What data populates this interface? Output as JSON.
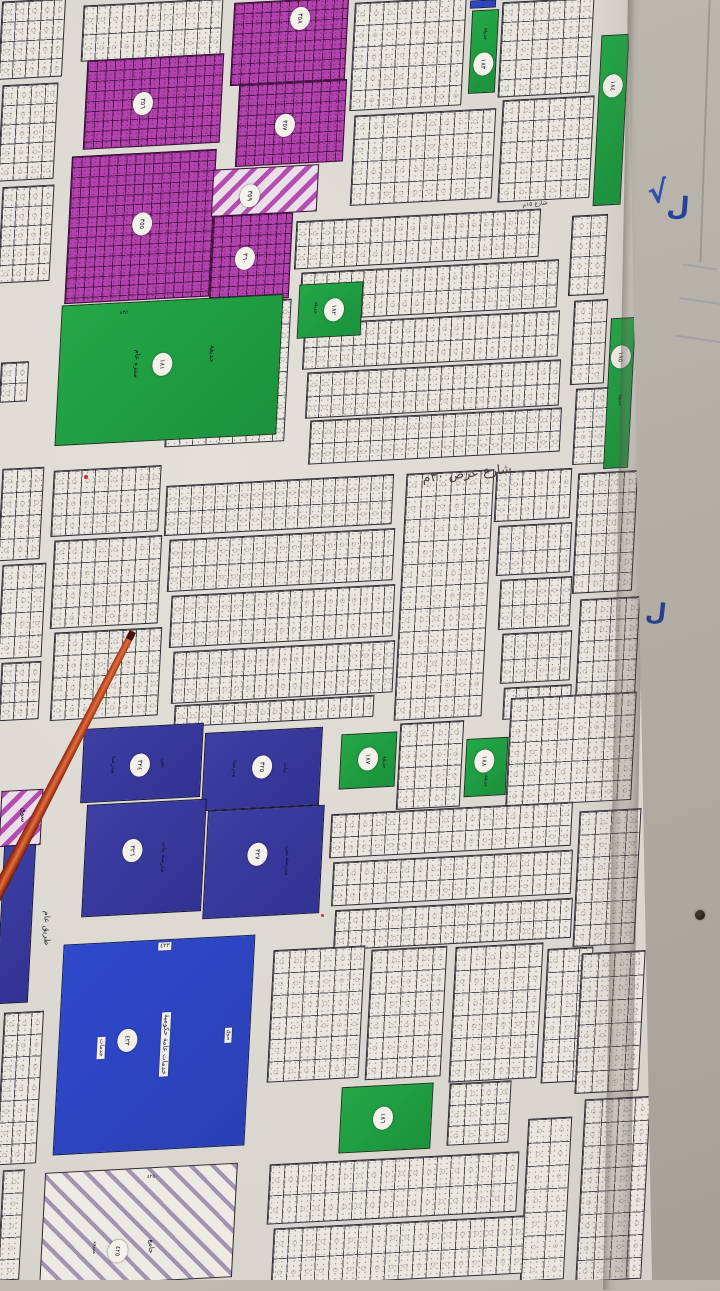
{
  "map": {
    "blocks": [
      {
        "x": 0,
        "y": 0,
        "w": 64,
        "h": 78,
        "t": "g",
        "c": 5,
        "r": 4
      },
      {
        "x": 0,
        "y": 84,
        "w": 56,
        "h": 96,
        "t": "g",
        "c": 4,
        "r": 5
      },
      {
        "x": 0,
        "y": 186,
        "w": 52,
        "h": 96,
        "t": "g",
        "c": 4,
        "r": 5
      },
      {
        "x": 82,
        "y": 2,
        "w": 140,
        "h": 56,
        "t": "g",
        "c": 11,
        "r": 2
      },
      {
        "x": 0,
        "y": 362,
        "w": 28,
        "h": 40,
        "t": "g",
        "c": 2,
        "r": 2
      },
      {
        "x": 352,
        "y": 0,
        "w": 112,
        "h": 108,
        "t": "g",
        "c": 8,
        "r": 5
      },
      {
        "x": 500,
        "y": 0,
        "w": 92,
        "h": 95,
        "t": "g",
        "c": 6,
        "r": 5
      },
      {
        "x": 500,
        "y": 98,
        "w": 92,
        "h": 102,
        "t": "g",
        "c": 6,
        "r": 5
      },
      {
        "x": 352,
        "y": 112,
        "w": 142,
        "h": 90,
        "t": "g",
        "c": 10,
        "r": 4
      },
      {
        "x": 235,
        "y": 218,
        "w": 52,
        "h": 80,
        "t": "g",
        "c": 4,
        "r": 4
      },
      {
        "x": 168,
        "y": 302,
        "w": 120,
        "h": 142,
        "t": "g",
        "c": 9,
        "r": 6
      },
      {
        "x": 295,
        "y": 215,
        "w": 245,
        "h": 48,
        "t": "g",
        "c": 20,
        "r": 2
      },
      {
        "x": 300,
        "y": 266,
        "w": 258,
        "h": 48,
        "t": "g",
        "c": 21,
        "r": 2
      },
      {
        "x": 303,
        "y": 317,
        "w": 256,
        "h": 46,
        "t": "g",
        "c": 21,
        "r": 2
      },
      {
        "x": 306,
        "y": 366,
        "w": 254,
        "h": 46,
        "t": "g",
        "c": 21,
        "r": 2
      },
      {
        "x": 309,
        "y": 414,
        "w": 252,
        "h": 44,
        "t": "g",
        "c": 21,
        "r": 2
      },
      {
        "x": 570,
        "y": 215,
        "w": 36,
        "h": 80,
        "t": "g",
        "c": 2,
        "r": 4
      },
      {
        "x": 572,
        "y": 300,
        "w": 34,
        "h": 84,
        "t": "g",
        "c": 2,
        "r": 4
      },
      {
        "x": 574,
        "y": 388,
        "w": 34,
        "h": 76,
        "t": "g",
        "c": 2,
        "r": 4
      },
      {
        "x": 0,
        "y": 468,
        "w": 42,
        "h": 92,
        "t": "g",
        "c": 3,
        "r": 4
      },
      {
        "x": 0,
        "y": 564,
        "w": 44,
        "h": 94,
        "t": "g",
        "c": 3,
        "r": 4
      },
      {
        "x": 0,
        "y": 662,
        "w": 40,
        "h": 58,
        "t": "g",
        "c": 3,
        "r": 3
      },
      {
        "x": 52,
        "y": 468,
        "w": 108,
        "h": 66,
        "t": "g",
        "c": 8,
        "r": 3
      },
      {
        "x": 52,
        "y": 538,
        "w": 108,
        "h": 88,
        "t": "g",
        "c": 8,
        "r": 4
      },
      {
        "x": 52,
        "y": 630,
        "w": 108,
        "h": 88,
        "t": "g",
        "c": 8,
        "r": 4
      },
      {
        "x": 165,
        "y": 480,
        "w": 228,
        "h": 50,
        "t": "g",
        "c": 19,
        "r": 2
      },
      {
        "x": 168,
        "y": 534,
        "w": 226,
        "h": 52,
        "t": "g",
        "c": 19,
        "r": 2
      },
      {
        "x": 170,
        "y": 590,
        "w": 224,
        "h": 52,
        "t": "g",
        "c": 19,
        "r": 2
      },
      {
        "x": 172,
        "y": 646,
        "w": 222,
        "h": 52,
        "t": "g",
        "c": 19,
        "r": 2
      },
      {
        "x": 174,
        "y": 700,
        "w": 200,
        "h": 22,
        "t": "g",
        "c": 17,
        "r": 1
      },
      {
        "x": 400,
        "y": 472,
        "w": 88,
        "h": 246,
        "t": "g",
        "c": 6,
        "r": 11
      },
      {
        "x": 495,
        "y": 470,
        "w": 76,
        "h": 50,
        "t": "g",
        "c": 6,
        "r": 2
      },
      {
        "x": 497,
        "y": 524,
        "w": 74,
        "h": 50,
        "t": "g",
        "c": 6,
        "r": 2
      },
      {
        "x": 499,
        "y": 578,
        "w": 72,
        "h": 50,
        "t": "g",
        "c": 6,
        "r": 2
      },
      {
        "x": 501,
        "y": 632,
        "w": 70,
        "h": 50,
        "t": "g",
        "c": 6,
        "r": 2
      },
      {
        "x": 503,
        "y": 686,
        "w": 68,
        "h": 32,
        "t": "g",
        "c": 6,
        "r": 1
      },
      {
        "x": 575,
        "y": 472,
        "w": 60,
        "h": 120,
        "t": "g",
        "c": 4,
        "r": 6
      },
      {
        "x": 577,
        "y": 598,
        "w": 60,
        "h": 122,
        "t": "g",
        "c": 4,
        "r": 6
      },
      {
        "x": 398,
        "y": 722,
        "w": 64,
        "h": 86,
        "t": "g",
        "c": 4,
        "r": 4
      },
      {
        "x": 508,
        "y": 695,
        "w": 126,
        "h": 108,
        "t": "g",
        "c": 8,
        "r": 5
      },
      {
        "x": 330,
        "y": 808,
        "w": 242,
        "h": 44,
        "t": "g",
        "c": 18,
        "r": 2
      },
      {
        "x": 332,
        "y": 856,
        "w": 240,
        "h": 44,
        "t": "g",
        "c": 18,
        "r": 2
      },
      {
        "x": 334,
        "y": 904,
        "w": 238,
        "h": 40,
        "t": "g",
        "c": 18,
        "r": 2
      },
      {
        "x": 576,
        "y": 810,
        "w": 62,
        "h": 135,
        "t": "g",
        "c": 4,
        "r": 6
      },
      {
        "x": 0,
        "y": 1012,
        "w": 40,
        "h": 152,
        "t": "g",
        "c": 3,
        "r": 7
      },
      {
        "x": 0,
        "y": 1170,
        "w": 22,
        "h": 110,
        "t": "g",
        "c": 1,
        "r": 5
      },
      {
        "x": 270,
        "y": 948,
        "w": 92,
        "h": 132,
        "t": "g",
        "c": 6,
        "r": 6
      },
      {
        "x": 368,
        "y": 948,
        "w": 76,
        "h": 130,
        "t": "g",
        "c": 5,
        "r": 6
      },
      {
        "x": 452,
        "y": 945,
        "w": 88,
        "h": 135,
        "t": "g",
        "c": 6,
        "r": 6
      },
      {
        "x": 544,
        "y": 948,
        "w": 46,
        "h": 134,
        "t": "g",
        "c": 3,
        "r": 6
      },
      {
        "x": 578,
        "y": 952,
        "w": 64,
        "h": 140,
        "t": "g",
        "c": 4,
        "r": 6
      },
      {
        "x": 524,
        "y": 1118,
        "w": 44,
        "h": 162,
        "t": "g",
        "c": 2,
        "r": 7
      },
      {
        "x": 580,
        "y": 1098,
        "w": 66,
        "h": 182,
        "t": "g",
        "c": 4,
        "r": 8
      },
      {
        "x": 448,
        "y": 1082,
        "w": 62,
        "h": 62,
        "t": "g",
        "c": 4,
        "r": 3
      },
      {
        "x": 268,
        "y": 1158,
        "w": 250,
        "h": 60,
        "t": "g",
        "c": 18,
        "r": 2
      },
      {
        "x": 272,
        "y": 1222,
        "w": 252,
        "h": 58,
        "t": "g",
        "c": 18,
        "r": 2
      },
      {
        "x": 232,
        "y": 0,
        "w": 115,
        "h": 83,
        "t": "p",
        "circ": {
          "cx": 58,
          "cy": 22,
          "n": "٣٥٨"
        }
      },
      {
        "x": 85,
        "y": 57,
        "w": 137,
        "h": 89,
        "t": "p",
        "circ": {
          "cx": 42,
          "cy": 52,
          "n": "٣٥٦"
        }
      },
      {
        "x": 237,
        "y": 82,
        "w": 108,
        "h": 82,
        "t": "p",
        "circ": {
          "cx": 44,
          "cy": 52,
          "n": "٣٥٧"
        }
      },
      {
        "x": 68,
        "y": 153,
        "w": 145,
        "h": 147,
        "t": "p",
        "circ": {
          "cx": 51,
          "cy": 48,
          "n": "٣٥٥"
        }
      },
      {
        "x": 212,
        "y": 167,
        "w": 106,
        "h": 47,
        "t": "hp",
        "circ": {
          "cx": 36,
          "cy": 60,
          "n": "٣٥٩"
        }
      },
      {
        "x": 211,
        "y": 214,
        "w": 80,
        "h": 86,
        "t": "p",
        "circ": {
          "cx": 42,
          "cy": 51,
          "n": "٣٦٠"
        }
      },
      {
        "x": 58,
        "y": 300,
        "w": 222,
        "h": 140,
        "t": "gr",
        "circ": {
          "cx": 47,
          "cy": 46,
          "n": "١٨١"
        },
        "labels": [
          {
            "t": "منتزه عام",
            "dx": 35,
            "dy": 44,
            "rot": 90,
            "s": 7
          },
          {
            "t": "حديقة",
            "dx": 69,
            "dy": 40,
            "rot": 90,
            "s": 7
          },
          {
            "t": "٤٣٥",
            "dx": 28,
            "dy": 7,
            "s": 5
          }
        ]
      },
      {
        "x": 298,
        "y": 283,
        "w": 64,
        "h": 54,
        "t": "gr",
        "circ": {
          "cx": 56,
          "cy": 50,
          "n": "١٨٢"
        },
        "labels": [
          {
            "t": "حديقة",
            "dx": 26,
            "dy": 45,
            "rot": 90,
            "s": 5
          }
        ]
      },
      {
        "x": 470,
        "y": 10,
        "w": 27,
        "h": 83,
        "t": "gr",
        "circ": {
          "cx": 50,
          "cy": 66,
          "n": "١٨٣"
        },
        "labels": [
          {
            "t": "حديقة",
            "dx": 50,
            "dy": 28,
            "rot": 90,
            "s": 5
          }
        ]
      },
      {
        "x": 597,
        "y": 35,
        "w": 28,
        "h": 170,
        "t": "gr",
        "circ": {
          "cx": 50,
          "cy": 30,
          "n": "١٨٤"
        }
      },
      {
        "x": 607,
        "y": 318,
        "w": 25,
        "h": 150,
        "t": "gr",
        "circ": {
          "cx": 48,
          "cy": 26,
          "n": "١٨٥"
        },
        "labels": [
          {
            "t": "حديقة",
            "dx": 52,
            "dy": 55,
            "rot": 90,
            "s": 5
          }
        ]
      },
      {
        "x": 82,
        "y": 726,
        "w": 120,
        "h": 74,
        "t": "in",
        "circ": {
          "cx": 48,
          "cy": 53,
          "n": "٣٢٤"
        },
        "labels": [
          {
            "t": "مدرسة",
            "dx": 25,
            "dy": 50,
            "rot": 90,
            "s": 6,
            "col": "#101035"
          },
          {
            "t": "بنين",
            "dx": 68,
            "dy": 52,
            "rot": 90,
            "s": 6,
            "col": "#101035"
          }
        ]
      },
      {
        "x": 203,
        "y": 730,
        "w": 118,
        "h": 78,
        "t": "in",
        "circ": {
          "cx": 50,
          "cy": 48,
          "n": "٣٢٥"
        },
        "labels": [
          {
            "t": "مدرسة",
            "dx": 26,
            "dy": 48,
            "rot": 90,
            "s": 6,
            "col": "#101035"
          },
          {
            "t": "بنات",
            "dx": 70,
            "dy": 50,
            "rot": 90,
            "s": 6,
            "col": "#101035"
          }
        ]
      },
      {
        "x": 84,
        "y": 802,
        "w": 120,
        "h": 112,
        "t": "in",
        "circ": {
          "cx": 40,
          "cy": 43,
          "n": "٣٢٦"
        },
        "labels": [
          {
            "t": "مدرسة بنات",
            "dx": 66,
            "dy": 50,
            "rot": 90,
            "s": 6,
            "col": "#101035"
          }
        ]
      },
      {
        "x": 205,
        "y": 808,
        "w": 117,
        "h": 108,
        "t": "in",
        "circ": {
          "cx": 44,
          "cy": 42,
          "n": "٣٢٧"
        },
        "labels": [
          {
            "t": "مدرسة بنين",
            "dx": 70,
            "dy": 50,
            "rot": 90,
            "s": 6,
            "col": "#101035"
          }
        ]
      },
      {
        "x": 340,
        "y": 733,
        "w": 56,
        "h": 55,
        "t": "gr",
        "circ": {
          "cx": 50,
          "cy": 48,
          "n": "١٨٧"
        },
        "labels": [
          {
            "t": "حديقة",
            "dx": 80,
            "dy": 55,
            "rot": 90,
            "s": 5
          }
        ]
      },
      {
        "x": 465,
        "y": 738,
        "w": 42,
        "h": 58,
        "t": "gr",
        "circ": {
          "cx": 46,
          "cy": 40,
          "n": "١٨٨"
        },
        "labels": [
          {
            "t": "حديقة",
            "dx": 50,
            "dy": 75,
            "rot": 90,
            "s": 5
          }
        ]
      },
      {
        "x": 0,
        "y": 790,
        "w": 42,
        "h": 56,
        "t": "hp",
        "labels": [
          {
            "t": "سوق",
            "dx": 55,
            "dy": 45,
            "rot": 90,
            "s": 7
          }
        ]
      },
      {
        "x": 0,
        "y": 845,
        "w": 32,
        "h": 158,
        "t": "in"
      },
      {
        "x": 58,
        "y": 940,
        "w": 192,
        "h": 210,
        "t": "ro",
        "circ": {
          "cx": 36,
          "cy": 47,
          "n": "٤٢٣"
        },
        "labels": [
          {
            "t": "٤٢٣",
            "dx": 53,
            "dy": 3,
            "s": 6,
            "box": 1
          },
          {
            "t": "خدمات عامة حكومية",
            "dx": 56,
            "dy": 50,
            "rot": 90,
            "s": 7,
            "box": 1
          },
          {
            "t": "خدمات",
            "dx": 22,
            "dy": 50,
            "rot": 90,
            "s": 6,
            "box": 1
          },
          {
            "t": "سوق",
            "dx": 89,
            "dy": 47,
            "rot": 90,
            "s": 5,
            "box": 1
          }
        ]
      },
      {
        "x": 42,
        "y": 1168,
        "w": 193,
        "h": 114,
        "t": "hw",
        "circ": {
          "cx": 40,
          "cy": 72,
          "n": "٤٢٥"
        },
        "labels": [
          {
            "t": "جامع",
            "dx": 57,
            "dy": 70,
            "rot": 90,
            "s": 7
          },
          {
            "t": "٤٢٥٠",
            "dx": 56,
            "dy": 8,
            "s": 5
          },
          {
            "t": "مسجد",
            "dx": 27,
            "dy": 68,
            "rot": 90,
            "s": 5
          }
        ]
      },
      {
        "x": 340,
        "y": 1085,
        "w": 92,
        "h": 66,
        "t": "gr",
        "circ": {
          "cx": 47,
          "cy": 50,
          "n": "١٨٦"
        }
      },
      {
        "x": 470,
        "y": 0,
        "w": 26,
        "h": 8,
        "t": "ro"
      }
    ],
    "road_labels": [
      {
        "t": "طريق عام ٤٠م",
        "x": 641,
        "y": 300,
        "rot": 90,
        "s": 9
      },
      {
        "t": "طريق عام ٤٠م",
        "x": 659,
        "y": 952,
        "rot": 90,
        "s": 9
      },
      {
        "t": "طريق عام",
        "x": 47,
        "y": 928,
        "rot": 90,
        "s": 8
      },
      {
        "t": "شارع عرض ٣٠م",
        "x": 467,
        "y": 474,
        "rot": -6,
        "s": 13,
        "big": 1
      },
      {
        "t": "شارع ١٥م",
        "x": 535,
        "y": 204,
        "rot": -6,
        "s": 6
      }
    ]
  },
  "scene": {
    "wall_marks": [
      {
        "t": "√",
        "x": 658,
        "y": 193,
        "s": 30,
        "rot": -8,
        "col": "#2d50ae"
      },
      {
        "t": "ل",
        "x": 678,
        "y": 207,
        "s": 26,
        "rot": 4,
        "col": "#24439c"
      },
      {
        "t": "ل",
        "x": 656,
        "y": 612,
        "s": 24,
        "rot": 6,
        "col": "#27408f"
      }
    ],
    "black_dot": {
      "x": 700,
      "y": 915,
      "d": 10
    },
    "red_specks": [
      {
        "x": 86,
        "y": 477,
        "d": 4
      },
      {
        "x": 322,
        "y": 915,
        "d": 3
      }
    ],
    "streaks": [
      {
        "x": 683,
        "y": 266,
        "w": 34
      },
      {
        "x": 679,
        "y": 300,
        "w": 42
      },
      {
        "x": 676,
        "y": 338,
        "w": 46
      }
    ],
    "colors": {
      "paper": "#dad7d0",
      "wall": "#b4b0a8",
      "plot_fill": "#e9e6df",
      "purple": "#b243ad",
      "green": "#1f9e40",
      "indigo": "#3a3c9e",
      "royal_blue": "#2d45c4",
      "stick": "#b23f1d",
      "ink": "#2d50ae"
    }
  }
}
